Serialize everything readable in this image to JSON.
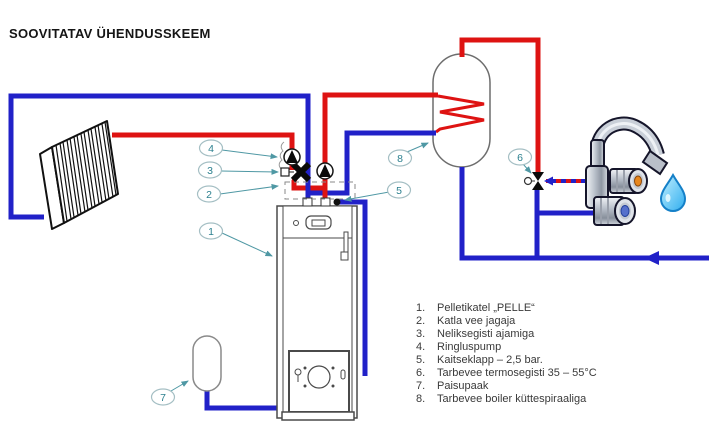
{
  "title": "SOOVITATAV ÜHENDUSSKEEM",
  "colors": {
    "supply_pipe": "#de1312",
    "return_pipe": "#2121c8",
    "callout_teal": "#2c808f",
    "callout_outline": "#a5bfc4",
    "device_outline": "#4a4a4a",
    "mixed_water_line": "dashed red/blue"
  },
  "icons": {
    "pump": "filled-triangle-in-circle",
    "four_way_mixing_valve": "black-x-valve",
    "thermostatic_mixer": "black-bowtie-with-round-handle",
    "safety_valve": "black-dot",
    "water_drop": "blue-droplet",
    "cold_water_flow": "left-pointing-arrow"
  },
  "callouts": [
    {
      "number": "1"
    },
    {
      "number": "2"
    },
    {
      "number": "3"
    },
    {
      "number": "4"
    },
    {
      "number": "5"
    },
    {
      "number": "6"
    },
    {
      "number": "7"
    },
    {
      "number": "8"
    }
  ],
  "legend": {
    "items": [
      {
        "num": "1.",
        "text": "Pelletikatel „PELLE“"
      },
      {
        "num": "2.",
        "text": "Katla vee jagaja"
      },
      {
        "num": "3.",
        "text": "Neliksegisti ajamiga"
      },
      {
        "num": "4.",
        "text": "Ringluspump"
      },
      {
        "num": "5.",
        "text": "Kaitseklapp – 2,5 bar."
      },
      {
        "num": "6.",
        "text": "Tarbevee termosegisti 35 – 55°C"
      },
      {
        "num": "7.",
        "text": "Paisupaak"
      },
      {
        "num": "8.",
        "text": "Tarbevee boiler küttespiraaliga"
      }
    ]
  }
}
